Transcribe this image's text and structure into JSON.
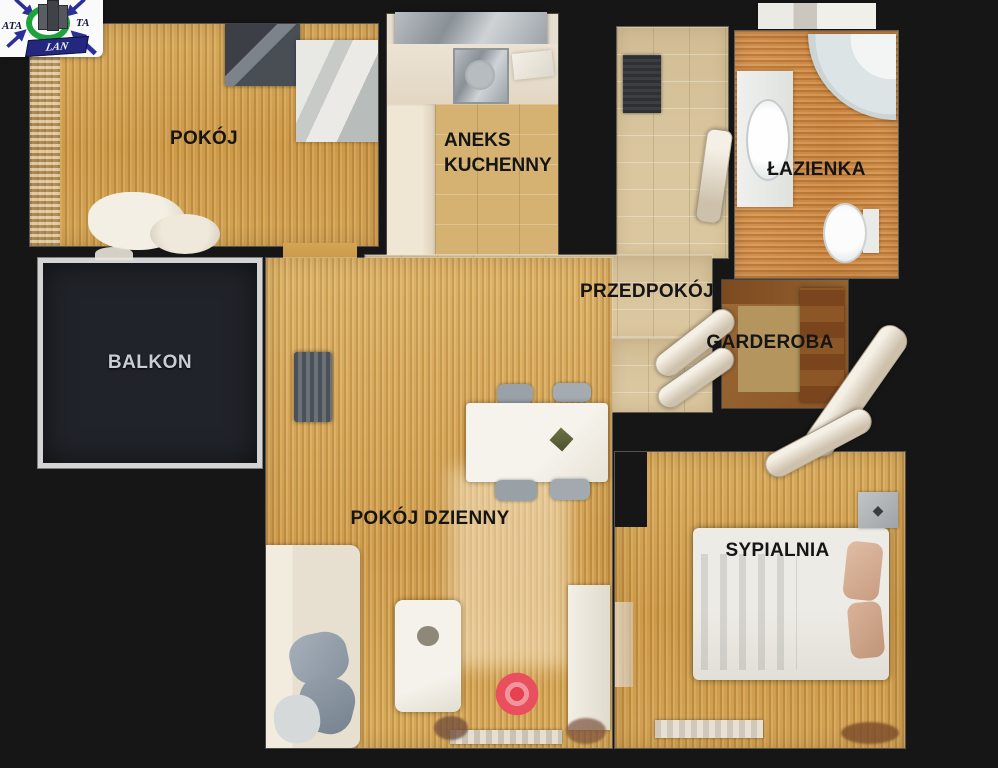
{
  "logo": {
    "text_left": "ATA",
    "text_right": "TA",
    "banner": "LAN"
  },
  "rooms": {
    "pokoj": {
      "label": "POKÓJ"
    },
    "aneks": {
      "label_line1": "ANEKS",
      "label_line2": "KUCHENNY"
    },
    "lazienka": {
      "label": "ŁAZIENKA"
    },
    "przedpokoj": {
      "label": "PRZEDPOKÓJ"
    },
    "garderoba": {
      "label": "GARDEROBA"
    },
    "balkon": {
      "label": "BALKON"
    },
    "pokoj_dzienny": {
      "label": "POKÓJ DZIENNY"
    },
    "sypialnia": {
      "label": "SYPIALNIA"
    }
  },
  "marker": {
    "type": "camera-waypoint",
    "color": "#e84c5c"
  },
  "colors": {
    "background": "#161616",
    "wood_floor": "#d1a255",
    "tile_floor": "#dbc79f",
    "bathroom_floor": "#cd8f4b",
    "balcony_border": "#d4d4d4",
    "balcony_fill": "#202329",
    "label_text": "#151515",
    "balcony_label_text": "#c8cdd4",
    "logo_blue": "#2b2f9a",
    "logo_green": "#1ea33c"
  }
}
